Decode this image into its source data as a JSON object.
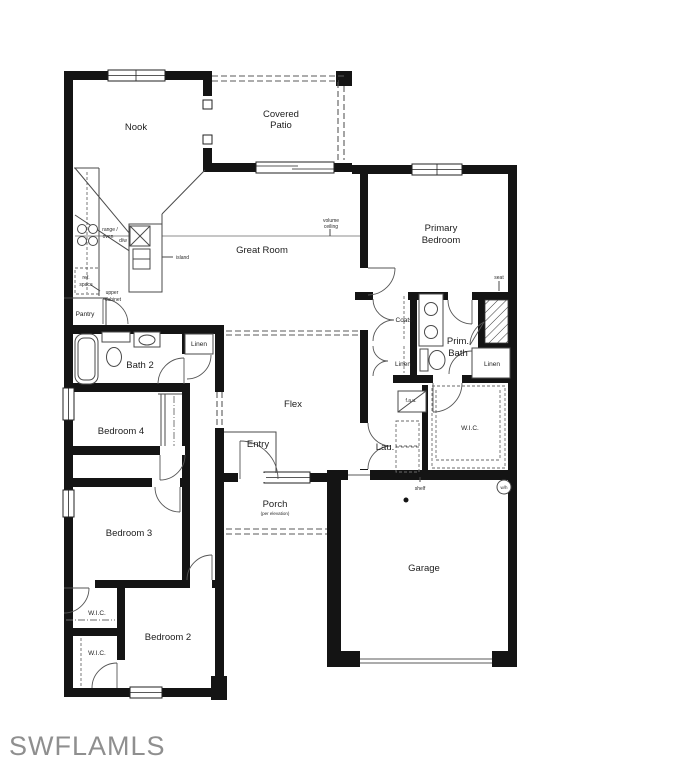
{
  "watermark": "SWFLAMLS",
  "rooms": {
    "nook": "Nook",
    "covered_patio": [
      "Covered",
      "Patio"
    ],
    "great_room": "Great Room",
    "primary_bedroom": [
      "Primary",
      "Bedroom"
    ],
    "pantry": "Pantry",
    "bath_2": "Bath 2",
    "bedroom_4": "Bedroom 4",
    "flex": "Flex",
    "entry": "Entry",
    "porch": "Porch",
    "porch_note": "(per elevation)",
    "bedroom_3": "Bedroom 3",
    "bedroom_2": "Bedroom 2",
    "wic_bedroom_3": "W.I.C.",
    "wic_bedroom_2": "W.I.C.",
    "prim_bath": [
      "Prim.",
      "Bath"
    ],
    "wic_primary": "W.I.C.",
    "laundry": "Lau.",
    "garage": "Garage",
    "coats": "Coats",
    "linen_hall": "Linen",
    "linen_primary_hall": "Linen",
    "linen_prim_bath": "Linen"
  },
  "annotations": {
    "range_oven": [
      "range /",
      "oven"
    ],
    "dishwasher": "d/w",
    "island": "island",
    "ref_space": [
      "ref.",
      "space"
    ],
    "upper_cabinet": [
      "upper",
      "cabinet"
    ],
    "volume_ceiling": [
      "volume",
      "ceiling"
    ],
    "seat": "seat",
    "fau": "f.a.u.",
    "shelf": "shelf",
    "water_heater": "w/h"
  },
  "colors": {
    "wall": "#141414",
    "thin_line": "#4a4a4a",
    "watermark": "#8f8f8f",
    "background": "#ffffff"
  }
}
